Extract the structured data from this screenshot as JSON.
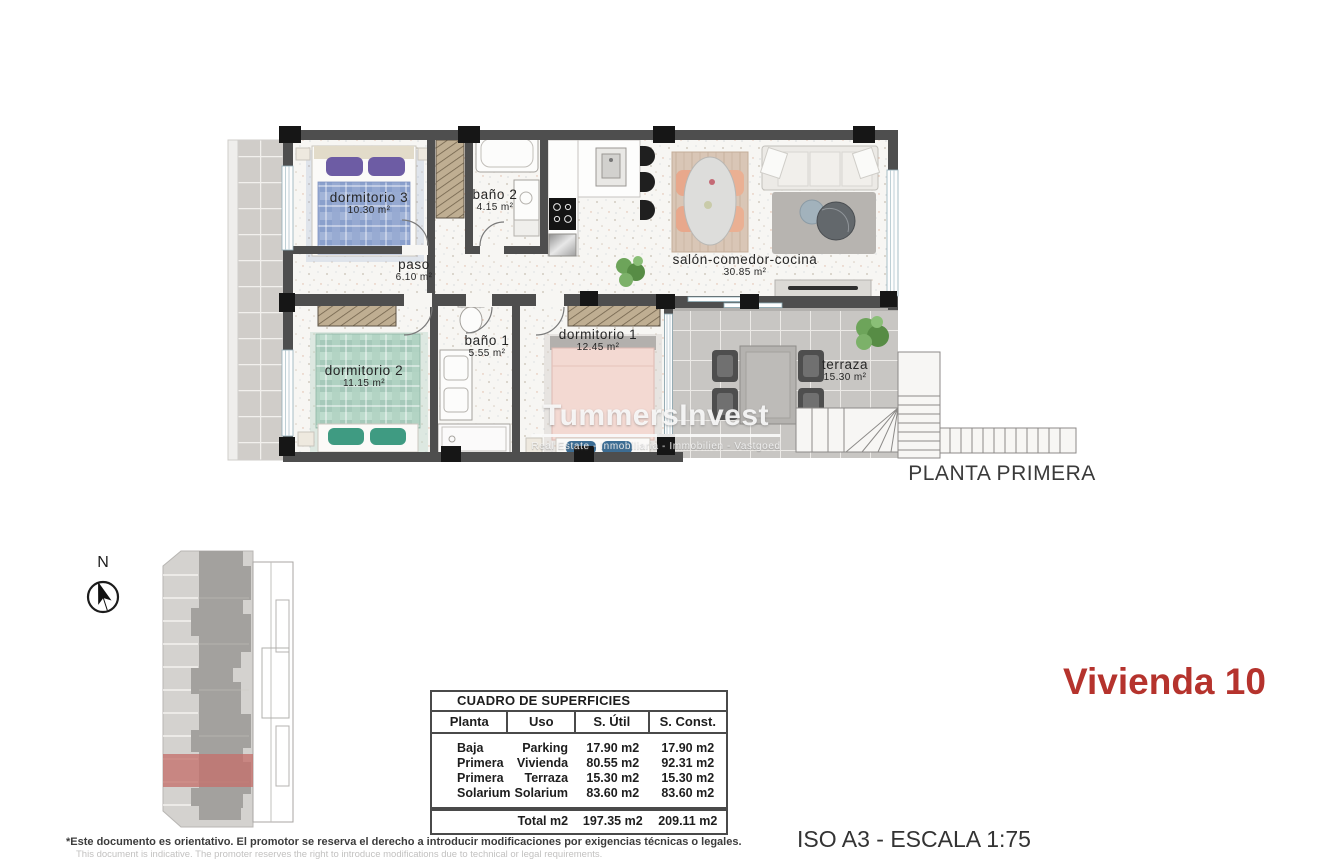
{
  "page": {
    "plan_title": "PLANTA PRIMERA",
    "unit_title": "Vivienda 10",
    "scale_note": "ISO A3 - ESCALA 1:75",
    "disclaimer_es": "*Este documento es orientativo. El promotor se reserva el derecho a introducir modificaciones por exigencias técnicas o legales.",
    "disclaimer_en": "This document is indicative. The promoter reserves the right to introduce modifications due to technical or legal requirements."
  },
  "compass": {
    "north_label": "N"
  },
  "watermark": {
    "brand": "TummersInvest",
    "tagline": "Real Estate - Inmobiliaria - Immobilien - Vastgoed"
  },
  "plan": {
    "rooms": [
      {
        "name": "dormitorio 3",
        "area": "10.30 m²"
      },
      {
        "name": "baño 2",
        "area": "4.15 m²"
      },
      {
        "name": "paso",
        "area": "6.10 m²"
      },
      {
        "name": "salón-comedor-cocina",
        "area": "30.85 m²"
      },
      {
        "name": "dormitorio 2",
        "area": "11.15 m²"
      },
      {
        "name": "baño 1",
        "area": "5.55 m²"
      },
      {
        "name": "dormitorio 1",
        "area": "12.45 m²"
      },
      {
        "name": "terraza",
        "area": "15.30 m²"
      }
    ]
  },
  "surface_table": {
    "title": "CUADRO DE SUPERFICIES",
    "columns": [
      "Planta",
      "Uso",
      "S. Útil",
      "S. Const."
    ],
    "rows": [
      [
        "Baja",
        "Parking",
        "17.90 m2",
        "17.90 m2"
      ],
      [
        "Primera",
        "Vivienda",
        "80.55 m2",
        "92.31 m2"
      ],
      [
        "Primera",
        "Terraza",
        "15.30 m2",
        "15.30 m2"
      ],
      [
        "Solarium",
        "Solarium",
        "83.60 m2",
        "83.60 m2"
      ]
    ],
    "total": {
      "label": "Total m2",
      "util": "197.35 m2",
      "const": "209.11 m2"
    }
  },
  "colors": {
    "accent_red": "#b5332d",
    "wall": "#4e4e4e",
    "site_highlight": "#c4716c"
  }
}
